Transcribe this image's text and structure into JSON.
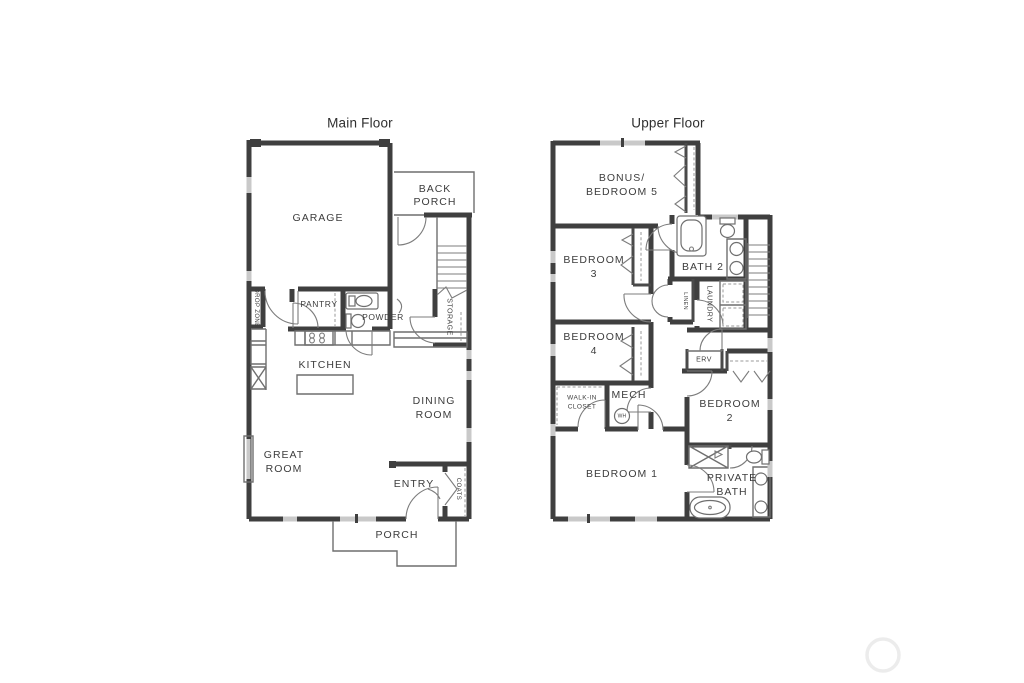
{
  "palette": {
    "background": "#ffffff",
    "wall": "#3f3f3f",
    "thin_line": "#6f6f6f",
    "window": "#c9c9c9",
    "text": "#3d3d3d",
    "watermark": "#ececec"
  },
  "main_floor": {
    "title": "Main Floor",
    "labels": {
      "garage": "GARAGE",
      "back_porch_line1": "BACK",
      "back_porch_line2": "PORCH",
      "storage": "STORAGE",
      "drop_zone": "DROP ZONE",
      "pantry": "PANTRY",
      "powder": "POWDER",
      "kitchen": "KITCHEN",
      "dining_line1": "DINING",
      "dining_line2": "ROOM",
      "great_line1": "GREAT",
      "great_line2": "ROOM",
      "entry": "ENTRY",
      "coats": "COATS",
      "porch": "PORCH"
    }
  },
  "upper_floor": {
    "title": "Upper Floor",
    "labels": {
      "bonus_line1": "BONUS/",
      "bonus_line2": "BEDROOM 5",
      "bedroom3_line1": "BEDROOM",
      "bedroom3_line2": "3",
      "bath2": "BATH 2",
      "linen": "LINEN",
      "laundry": "LAUNDRY",
      "bedroom4_line1": "BEDROOM",
      "bedroom4_line2": "4",
      "erv": "ERV",
      "mech": "MECH",
      "water_heater": "WH",
      "walk_in_line1": "WALK-IN",
      "walk_in_line2": "CLOSET",
      "bedroom2_line1": "BEDROOM",
      "bedroom2_line2": "2",
      "bedroom1": "BEDROOM 1",
      "private_bath_line1": "PRIVATE",
      "private_bath_line2": "BATH"
    }
  }
}
